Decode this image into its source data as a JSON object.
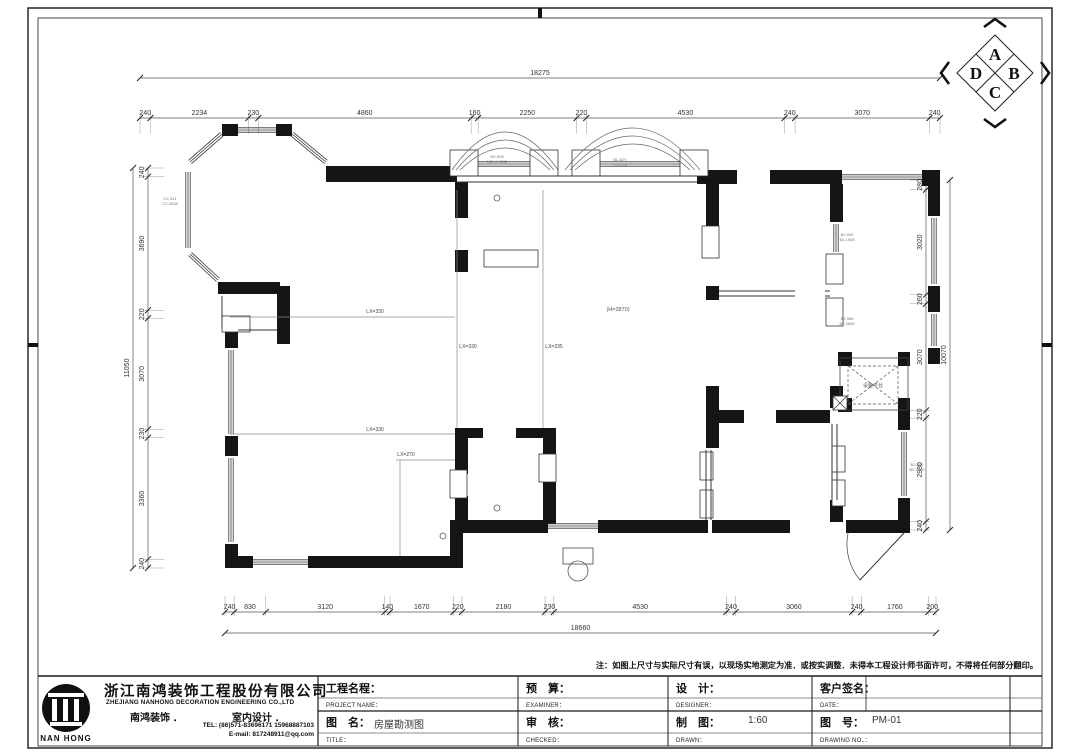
{
  "compass": {
    "letters": [
      "A",
      "B",
      "C",
      "D"
    ]
  },
  "dims": {
    "top": {
      "orient": "h",
      "line": 118,
      "from": 140,
      "to": 940,
      "ext": [
        -4,
        16
      ],
      "values": [
        240,
        2234,
        230,
        4860,
        160,
        2250,
        220,
        4530,
        240,
        3070,
        240
      ],
      "total": {
        "value": "18275",
        "line": 78
      }
    },
    "bottom": {
      "orient": "h",
      "line": 612,
      "from": 225,
      "to": 936,
      "ext": [
        -16,
        4
      ],
      "values": [
        240,
        830,
        3120,
        140,
        1670,
        220,
        2180,
        230,
        4530,
        240,
        3060,
        240,
        1760,
        200
      ],
      "total": {
        "value": "18660",
        "line": 633
      }
    },
    "left": {
      "orient": "v",
      "line": 148,
      "from": 168,
      "to": 568,
      "ext": [
        -4,
        16
      ],
      "values": [
        240,
        3690,
        220,
        3070,
        230,
        3360,
        240
      ],
      "total": {
        "value": "11050",
        "line": 133
      }
    },
    "right": {
      "orient": "v",
      "line": 926,
      "from": 180,
      "to": 530,
      "ext": [
        -16,
        4
      ],
      "values": [
        280,
        3020,
        260,
        3070,
        220,
        2980,
        240
      ],
      "total": {
        "value": "10070",
        "line": 950
      }
    }
  },
  "plan": {
    "black_rects": [
      [
        222,
        124,
        16,
        12
      ],
      [
        276,
        124,
        16,
        12
      ],
      [
        326,
        166,
        131,
        16
      ],
      [
        697,
        170,
        40,
        14
      ],
      [
        770,
        170,
        72,
        14
      ],
      [
        922,
        170,
        18,
        16
      ],
      [
        928,
        186,
        12,
        30
      ],
      [
        928,
        286,
        12,
        26
      ],
      [
        928,
        348,
        12,
        16
      ],
      [
        838,
        352,
        14,
        14
      ],
      [
        898,
        352,
        12,
        14
      ],
      [
        838,
        398,
        14,
        14
      ],
      [
        898,
        398,
        12,
        14
      ],
      [
        898,
        412,
        12,
        18
      ],
      [
        898,
        498,
        12,
        34
      ],
      [
        706,
        184,
        13,
        44
      ],
      [
        706,
        286,
        13,
        14
      ],
      [
        706,
        386,
        13,
        62
      ],
      [
        830,
        184,
        13,
        38
      ],
      [
        830,
        386,
        13,
        22
      ],
      [
        830,
        500,
        13,
        22
      ],
      [
        712,
        410,
        32,
        13
      ],
      [
        776,
        410,
        54,
        13
      ],
      [
        277,
        286,
        13,
        58
      ],
      [
        218,
        282,
        62,
        12
      ],
      [
        225,
        328,
        13,
        20
      ],
      [
        225,
        436,
        13,
        20
      ],
      [
        225,
        544,
        13,
        24
      ],
      [
        225,
        556,
        28,
        12
      ],
      [
        308,
        556,
        154,
        12
      ],
      [
        450,
        520,
        13,
        48
      ],
      [
        462,
        520,
        86,
        13
      ],
      [
        598,
        520,
        110,
        13
      ],
      [
        712,
        520,
        78,
        13
      ],
      [
        846,
        520,
        64,
        13
      ],
      [
        455,
        430,
        13,
        44
      ],
      [
        455,
        496,
        13,
        28
      ],
      [
        543,
        430,
        13,
        28
      ],
      [
        543,
        482,
        13,
        42
      ],
      [
        455,
        428,
        28,
        10
      ],
      [
        516,
        428,
        40,
        10
      ],
      [
        455,
        182,
        13,
        36
      ],
      [
        455,
        250,
        13,
        22
      ]
    ],
    "jamb_rects": [
      [
        450,
        150,
        28,
        26
      ],
      [
        530,
        150,
        28,
        26
      ],
      [
        572,
        150,
        28,
        26
      ],
      [
        680,
        150,
        28,
        26
      ],
      [
        702,
        226,
        17,
        32
      ],
      [
        826,
        254,
        17,
        30
      ],
      [
        826,
        298,
        17,
        28
      ],
      [
        450,
        470,
        17,
        28
      ],
      [
        539,
        454,
        17,
        28
      ],
      [
        700,
        452,
        13,
        28
      ],
      [
        700,
        490,
        13,
        28
      ],
      [
        832,
        446,
        13,
        26
      ],
      [
        832,
        480,
        13,
        26
      ],
      [
        222,
        316,
        28,
        16
      ],
      [
        484,
        250,
        54,
        17
      ]
    ],
    "windows": [
      [
        238,
        130,
        276,
        130
      ],
      [
        292,
        134,
        326,
        162
      ],
      [
        222,
        134,
        190,
        162
      ],
      [
        188,
        172,
        188,
        248
      ],
      [
        190,
        254,
        218,
        280
      ],
      [
        478,
        164,
        530,
        164
      ],
      [
        600,
        164,
        680,
        164
      ],
      [
        842,
        177,
        922,
        177
      ],
      [
        934,
        218,
        934,
        284
      ],
      [
        934,
        314,
        934,
        346
      ],
      [
        904,
        432,
        904,
        496
      ],
      [
        836,
        224,
        836,
        252
      ],
      [
        231,
        350,
        231,
        434
      ],
      [
        231,
        458,
        231,
        542
      ],
      [
        253,
        562,
        308,
        562
      ],
      [
        548,
        526,
        598,
        526
      ]
    ],
    "thin_lines": [
      [
        457,
        176,
        697,
        176
      ],
      [
        457,
        182,
        697,
        182
      ],
      [
        719,
        291,
        795,
        291
      ],
      [
        719,
        296,
        795,
        296
      ],
      [
        825,
        291,
        830,
        291
      ],
      [
        825,
        296,
        830,
        296
      ],
      [
        222,
        296,
        222,
        328
      ],
      [
        238,
        330,
        277,
        330
      ],
      [
        706,
        450,
        706,
        520
      ],
      [
        711,
        450,
        711,
        520
      ],
      [
        832,
        424,
        832,
        500
      ],
      [
        837,
        424,
        837,
        500
      ]
    ],
    "beam_lines": [
      [
        230,
        317,
        455,
        317
      ],
      [
        230,
        434,
        455,
        434
      ],
      [
        396,
        460,
        455,
        460
      ],
      [
        457,
        190,
        457,
        428
      ],
      [
        543,
        190,
        543,
        428
      ],
      [
        400,
        460,
        400,
        556
      ]
    ],
    "outline_rects": [
      [
        840,
        358,
        68,
        52
      ],
      [
        563,
        548,
        30,
        16
      ]
    ],
    "dash_rects": [
      [
        848,
        366,
        50,
        38
      ]
    ],
    "xboxes": [
      [
        833,
        396,
        14,
        14
      ]
    ],
    "bay_arcs": [
      [
        452,
        558,
        170,
        132
      ],
      [
        456,
        554,
        170,
        140
      ],
      [
        460,
        550,
        170,
        148
      ],
      [
        565,
        700,
        170,
        128
      ],
      [
        570,
        695,
        170,
        136
      ],
      [
        575,
        690,
        170,
        144
      ]
    ],
    "door": {
      "leaf": [
        904,
        533,
        860,
        580
      ],
      "arc": "M 860 580 A 56 56 0 0 1 848 533"
    },
    "circles": [
      [
        497,
        198,
        3
      ],
      [
        497,
        508,
        3
      ],
      [
        443,
        536,
        3
      ],
      [
        578,
        571,
        10
      ]
    ],
    "labels": [
      {
        "x": 170,
        "y": 200,
        "size": 4,
        "color": "#777",
        "lines": [
          "C2-341",
          "C2-3038"
        ]
      },
      {
        "x": 497,
        "y": 158,
        "size": 4,
        "color": "#777",
        "lines": [
          "BX-908",
          "MD-W-C35"
        ]
      },
      {
        "x": 620,
        "y": 161,
        "size": 4,
        "color": "#777",
        "lines": [
          "BL-82Y",
          "LT-3228"
        ]
      },
      {
        "x": 847,
        "y": 236,
        "size": 4,
        "color": "#777",
        "lines": [
          "BJ-908",
          "B2-1506"
        ]
      },
      {
        "x": 847,
        "y": 320,
        "size": 4,
        "color": "#777",
        "lines": [
          "BJ-968",
          "B2-2836"
        ]
      },
      {
        "x": 917,
        "y": 466,
        "size": 4,
        "color": "#777",
        "lines": [
          "BJ-281",
          "B2-2890"
        ]
      },
      {
        "x": 618,
        "y": 311,
        "size": 5.5,
        "color": "#555",
        "lines": [
          "(H=2870)"
        ]
      },
      {
        "x": 375,
        "y": 313,
        "size": 5,
        "color": "#444",
        "lines": [
          "LX=330"
        ]
      },
      {
        "x": 375,
        "y": 431,
        "size": 5,
        "color": "#444",
        "lines": [
          "LX=330"
        ]
      },
      {
        "x": 468,
        "y": 348,
        "size": 5,
        "color": "#444",
        "lines": [
          "LX=330"
        ]
      },
      {
        "x": 554,
        "y": 348,
        "size": 5,
        "color": "#444",
        "lines": [
          "LX=335"
        ]
      },
      {
        "x": 406,
        "y": 456,
        "size": 5,
        "color": "#444",
        "lines": [
          "LX=270"
        ]
      },
      {
        "x": 873,
        "y": 387,
        "size": 5,
        "color": "#555",
        "lines": [
          "设备平台"
        ]
      }
    ]
  },
  "frame": {
    "outer": [
      28,
      8,
      1024,
      740
    ],
    "inner": [
      38,
      18,
      1004,
      728
    ],
    "ticks": [
      [
        540,
        8,
        540,
        18
      ],
      [
        28,
        345,
        38,
        345
      ],
      [
        1042,
        345,
        1052,
        345
      ]
    ]
  },
  "titleblock": {
    "grid": {
      "hlines": [
        [
          38,
          676,
          1042,
          676,
          1.4
        ],
        [
          318,
          698,
          1042,
          698,
          0.5
        ],
        [
          318,
          711,
          1042,
          711,
          1.2
        ],
        [
          318,
          733,
          1042,
          733,
          0.5
        ]
      ],
      "vlines": [
        [
          318,
          676,
          746,
          1.2
        ],
        [
          518,
          676,
          746,
          1
        ],
        [
          668,
          676,
          746,
          1
        ],
        [
          812,
          676,
          746,
          1
        ],
        [
          866,
          676,
          711,
          0.8
        ],
        [
          1010,
          676,
          746,
          1
        ]
      ]
    },
    "note": "注：如图上尺寸与实际尺寸有误，以现场实地测定为准．或按实调整．未得本工程设计师书面许可，不得将任何部分翻印。",
    "company": {
      "logo_text": "NAN HONG",
      "name_cn": "浙江南鸿装饰工程股份有限公司",
      "name_en": "ZHEJIANG NANHONG DECORATION ENGINEERING CO.,LTD",
      "brand": "南鸿装饰 ．",
      "dept": "室内设计 ．",
      "tel": "TEL: (86)571-83696171 15968887103",
      "email": "E-mail: 817248911@qq.com"
    },
    "fields": {
      "project_cn": "工程名程：",
      "project_en": "PROJECT NAME：",
      "budget_cn": "预　算：",
      "budget_en": "EXAMINER：",
      "design_cn": "设　计：",
      "design_en": "DESIGNER：",
      "client_cn": "客户签名：",
      "client_en": "DATE：",
      "title_cn": "图　名：",
      "title_value": "房屋勘测图",
      "title_en": "TITLE：",
      "check_cn": "审　核：",
      "check_en": "CHECKED：",
      "draw_cn": "制　图：",
      "draw_scale": "1:60",
      "draw_en": "DRAWN：",
      "no_cn": "图　号：",
      "no_value": "PM-01",
      "no_en": "DRAWING NO．："
    }
  }
}
